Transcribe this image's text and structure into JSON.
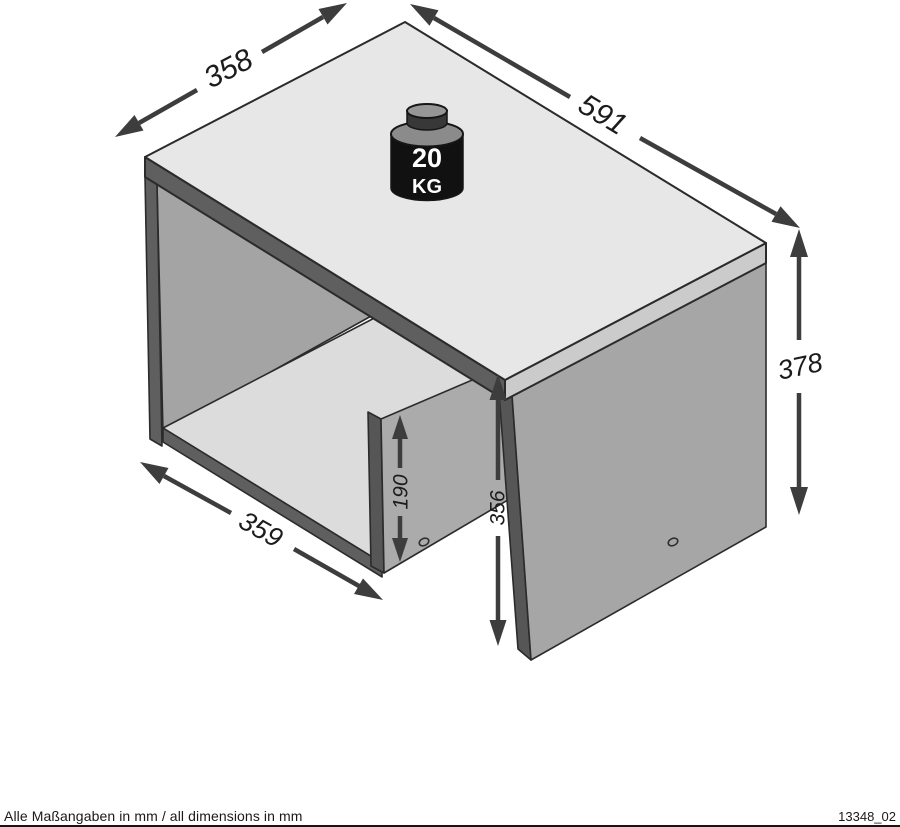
{
  "drawing": {
    "weight_badge": {
      "value": "20",
      "unit": "KG"
    },
    "dimensions": {
      "depth_top": "358",
      "width_top": "591",
      "height_right": "378",
      "shelf_width": "359",
      "divider_height": "190",
      "clearance_height": "356"
    },
    "footer": {
      "note": "Alle Maßangaben in mm / all dimensions in mm",
      "drawing_id": "13348_02"
    },
    "colors": {
      "outline": "#2b2b2b",
      "top_face": "#e7e7e7",
      "edge_light": "#cbcbcb",
      "edge_dark": "#5f5f5f",
      "panel_face": "#a6a6a6",
      "divider_face": "#ababab",
      "interior_face": "#a4a4a4",
      "shelf_face": "#dcdcdc",
      "arrow": "#3d3d3d",
      "weight_body": "#111111",
      "weight_knob": "#969696"
    }
  }
}
